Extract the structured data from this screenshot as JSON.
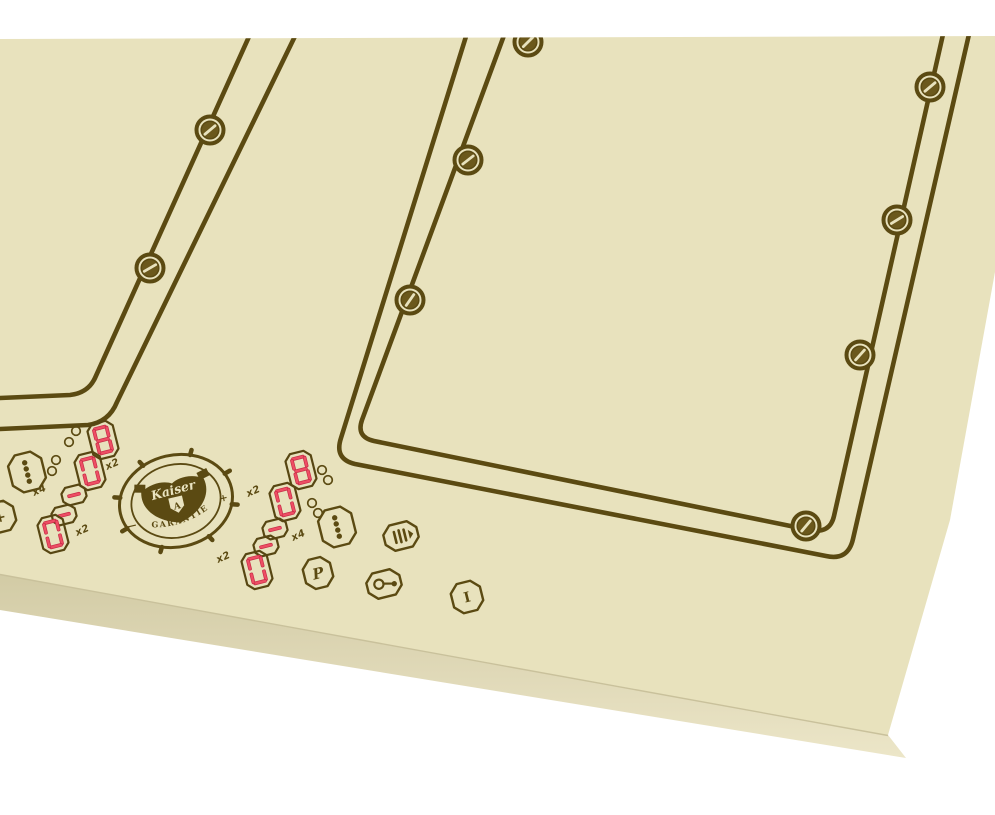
{
  "product": {
    "kind": "built-in induction hob, retro style, perspective product photo",
    "visible_zones": 2
  },
  "colors": {
    "background": "#ffffff",
    "glass_surface": "#e8e2bd",
    "front_edge_top": "#d2cba5",
    "front_edge_bottom": "#ece6c8",
    "engraving_brown": "#5b4a12",
    "screw_fill": "#6b581c",
    "digit": "#ee4e64",
    "digit_edge": "#c62b46"
  },
  "logo": {
    "brand": "Kaiser",
    "banner": "GARANTIE",
    "left_mark": "—",
    "right_mark": "+",
    "monogram": "A"
  },
  "zone1": {
    "digits": [
      "8",
      "0",
      "-",
      "-",
      "0"
    ],
    "multipliers": [
      "x2",
      "x4",
      "x2"
    ]
  },
  "zone2": {
    "digits": [
      "8",
      "0",
      "-",
      "-",
      "0"
    ],
    "multipliers": [
      "x2",
      "x4",
      "x2"
    ]
  },
  "buttons": {
    "plus": "+",
    "power_program": "P",
    "on_off": "I"
  },
  "icons": {
    "zone_selector": "four-vertical-dots",
    "heat_level": "three-bars-with-wedge",
    "child_lock": "key",
    "indicator_dots": "double-ring-pairs"
  }
}
